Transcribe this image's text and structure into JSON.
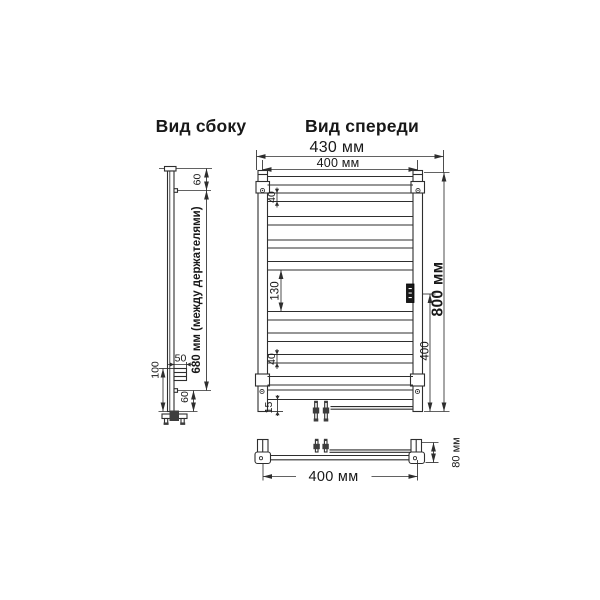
{
  "colors": {
    "background": "#ffffff",
    "line": "#2e2e2e",
    "text": "#181818",
    "badge": "#191919"
  },
  "views": {
    "side": {
      "title": "Вид сбоку",
      "dim_top_offset": "60",
      "dim_between_holders": "680 мм (между держателями)",
      "dim_holder_depth": "50",
      "dim_bottom_height": "100",
      "dim_bottom_offset": "60"
    },
    "front": {
      "title": "Вид спереди",
      "dim_overall_width": "430 мм",
      "dim_rail_width": "400 мм",
      "dim_rung_gap_top": "40",
      "dim_center_gap": "130",
      "dim_rung_gap_bottom": "40",
      "dim_bottom_margin": "15",
      "dim_overall_height": "800 мм",
      "dim_lower_half": "400"
    },
    "bottom": {
      "dim_width": "400 мм",
      "dim_depth": "80 мм"
    }
  }
}
